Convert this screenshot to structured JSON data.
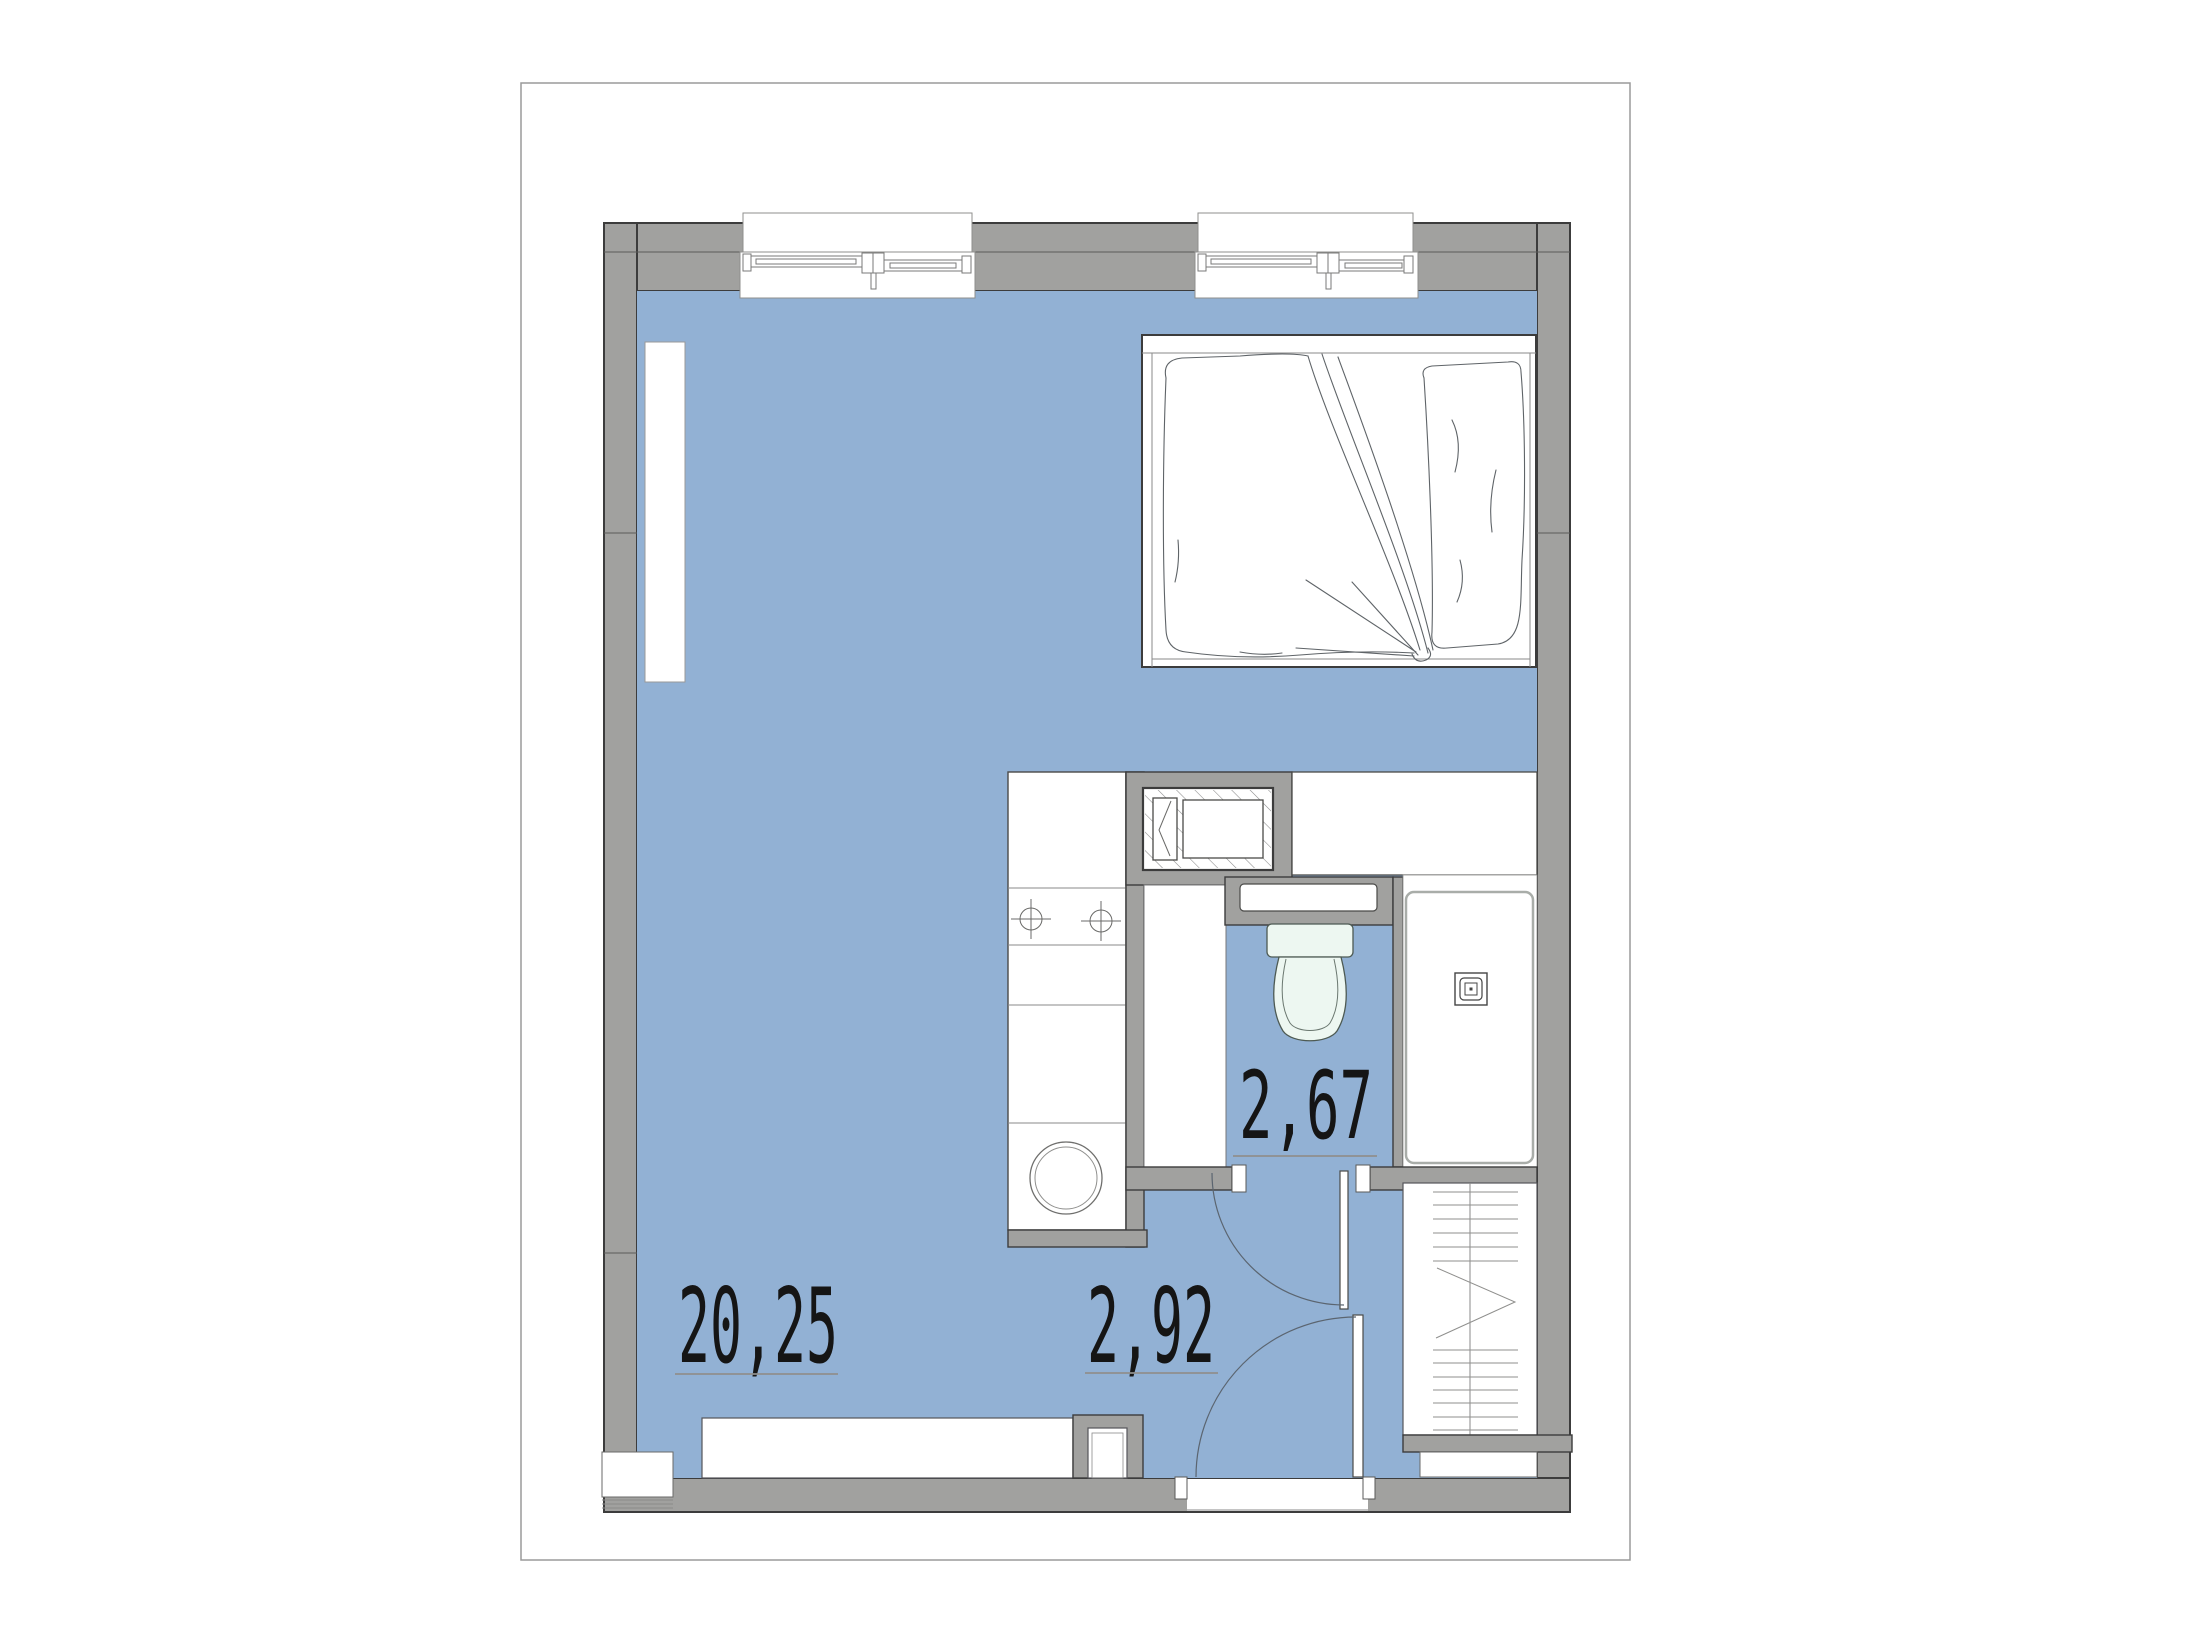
{
  "document": {
    "type": "apartment-floor-plan",
    "style": "studio apartment plan, blue floor fill, gray walls"
  },
  "rooms": {
    "living": {
      "name": "living-room-with-kitchen",
      "area": "20,25"
    },
    "hallway": {
      "name": "hallway",
      "area": "2,92"
    },
    "bathroom": {
      "name": "bathroom",
      "area": "2,67"
    }
  },
  "fixtures": [
    "window",
    "bed-with-pillow-and-duvet",
    "kitchen-counter",
    "hob-burners",
    "washing-machine",
    "appliance-niche",
    "bathroom-sink",
    "toilet",
    "shower-tray",
    "shower-drain",
    "wardrobe",
    "entrance-door",
    "bathroom-door",
    "radiator",
    "duct-shaft",
    "sideboard"
  ],
  "colors": {
    "floor": "#92b1d4",
    "wall": "#a1a19f",
    "outline": "#3c3c3c",
    "fixture_fill": "#edf7f1",
    "paper_border": "#9a9a9a",
    "sketch": "#5f6468"
  }
}
